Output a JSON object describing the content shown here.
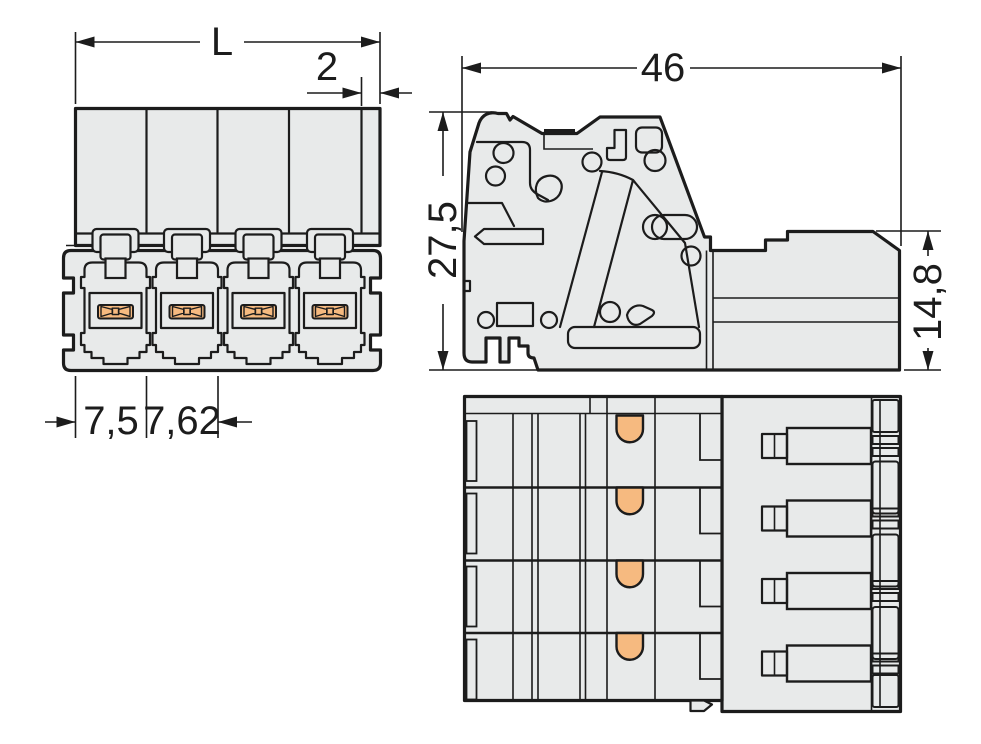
{
  "drawing": {
    "background": "#ffffff",
    "line_color": "#1c1c1c",
    "body_fill": "#e8eaea",
    "contact_fill": "#f6ba80"
  },
  "front_view": {
    "dim_total_length": "L",
    "dim_end_width": "2",
    "dim_first_pitch": "7,5",
    "dim_pole_pitch": "7,62"
  },
  "side_view": {
    "dim_depth": "46",
    "dim_height": "27,5",
    "dim_plug_height": "14,8"
  }
}
